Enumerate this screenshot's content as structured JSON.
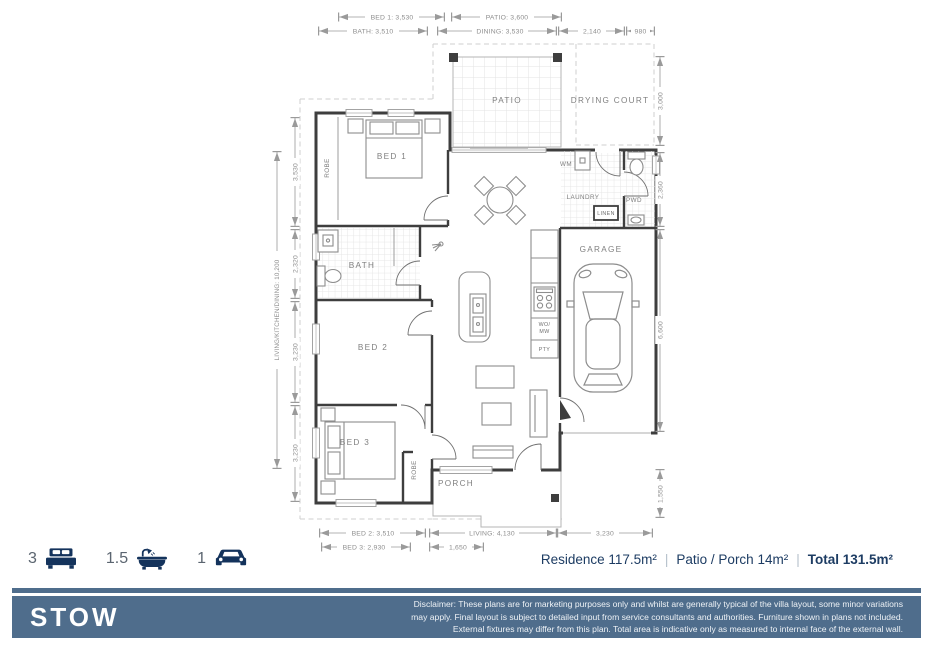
{
  "colors": {
    "navy": "#14335c",
    "slate": "#4f6d8c",
    "wall": "#3e3e3e",
    "dim_gray": "#8e8e8e",
    "label_gray": "#808080"
  },
  "rooms": {
    "patio": "PATIO",
    "drying_court": "DRYING COURT",
    "bed1": "BED 1",
    "bed2": "BED 2",
    "bed3": "BED 3",
    "bath": "BATH",
    "garage": "GARAGE",
    "laundry": "LAUNDRY",
    "pwd": "PWD",
    "porch": "PORCH",
    "robe1": "ROBE",
    "robe3": "ROBE",
    "wm": "WM",
    "linen": "LINEN",
    "wo": "WO/",
    "mw": "MW",
    "pty": "PTY"
  },
  "dims": {
    "top_bed1": "BED 1: 3,530",
    "top_patio": "PATIO: 3,600",
    "top_bath": "BATH: 3,510",
    "top_dining": "DINING: 3,530",
    "top_2140": "2,140",
    "top_980": "980",
    "right_3000": "3,000",
    "right_2360": "2,360",
    "right_6600": "6,600",
    "right_1550": "1,550",
    "left_3530": "3,530",
    "left_2320": "2,320",
    "left_3230a": "3,230",
    "left_3230b": "3,230",
    "left_lkd": "LIVING/KITCHEN/DINING: 10,200",
    "bottom_bed2": "BED 2: 3,510",
    "bottom_living": "LIVING: 4,130",
    "bottom_3230": "3,230",
    "bottom_bed3": "BED 3: 2,930",
    "bottom_1650": "1,650"
  },
  "summary": {
    "beds": "3",
    "baths": "1.5",
    "cars": "1",
    "residence": "Residence 117.5m²",
    "patio_porch": "Patio / Porch 14m²",
    "total": "Total 131.5m²",
    "separator": "|"
  },
  "footer": {
    "title": "STOW",
    "disclaimer": "Disclaimer: These plans are for marketing purposes only and whilst are generally typical of the villa layout, some minor variations may apply. Final layout is subject to detailed input from service consultants and authorities. Furniture shown in plans not included. External fixtures may differ from this plan. Total area is indicative only as measured to internal face of the external wall."
  }
}
